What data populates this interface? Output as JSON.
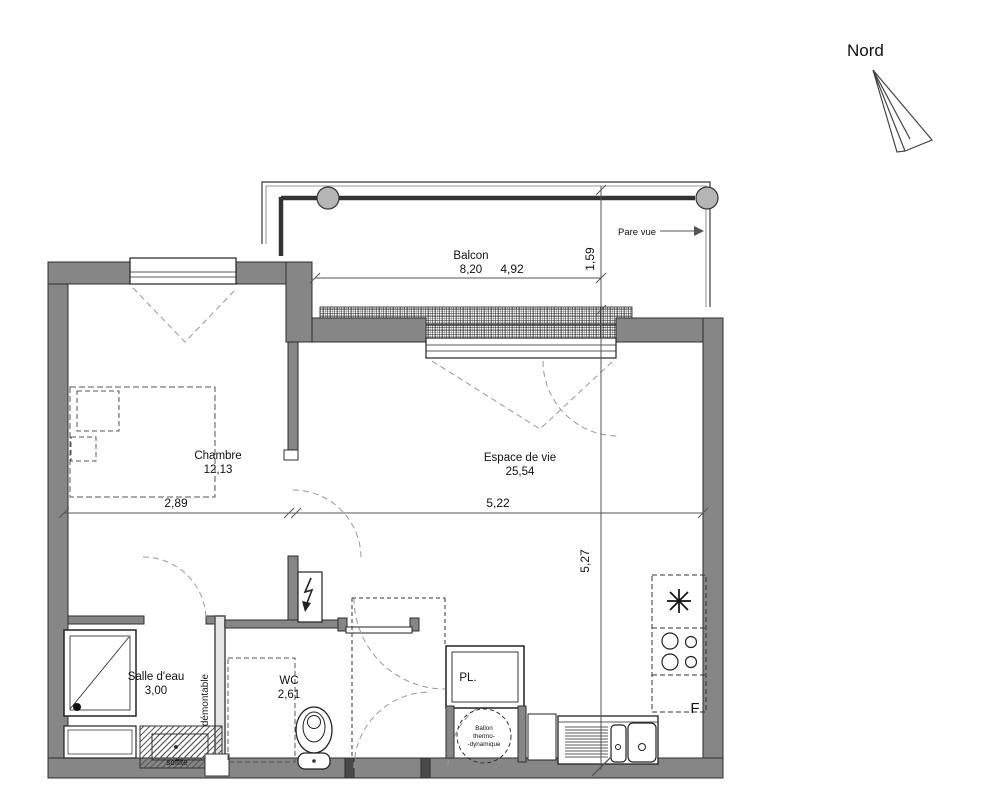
{
  "north": {
    "label": "Nord"
  },
  "balcony": {
    "name": "Balcon",
    "area": "8,20",
    "privacy_screen": "Pare vue"
  },
  "rooms": {
    "chambre": {
      "name": "Chambre",
      "area": "12,13"
    },
    "espace_de_vie": {
      "name": "Espace de vie",
      "area": "25,54"
    },
    "salle_deau": {
      "name": "Salle d'eau",
      "area": "3,00"
    },
    "wc": {
      "name": "WC",
      "area": "2,61"
    },
    "placard": {
      "name": "PL."
    }
  },
  "annotations": {
    "demontable": "démontable",
    "soffite": "soffite",
    "ballon_line1": "Ballon",
    "ballon_line2": "thermo-",
    "ballon_line3": "-dynamique",
    "fridge_marker": "F"
  },
  "dimensions": {
    "balcony_width": "4,92",
    "balcony_depth": "1,59",
    "chambre_width": "2,89",
    "living_width": "5,22",
    "living_depth": "5,27"
  },
  "colors": {
    "wall": "#868686",
    "line": "#333333",
    "dash": "#999999",
    "background": "#ffffff"
  }
}
